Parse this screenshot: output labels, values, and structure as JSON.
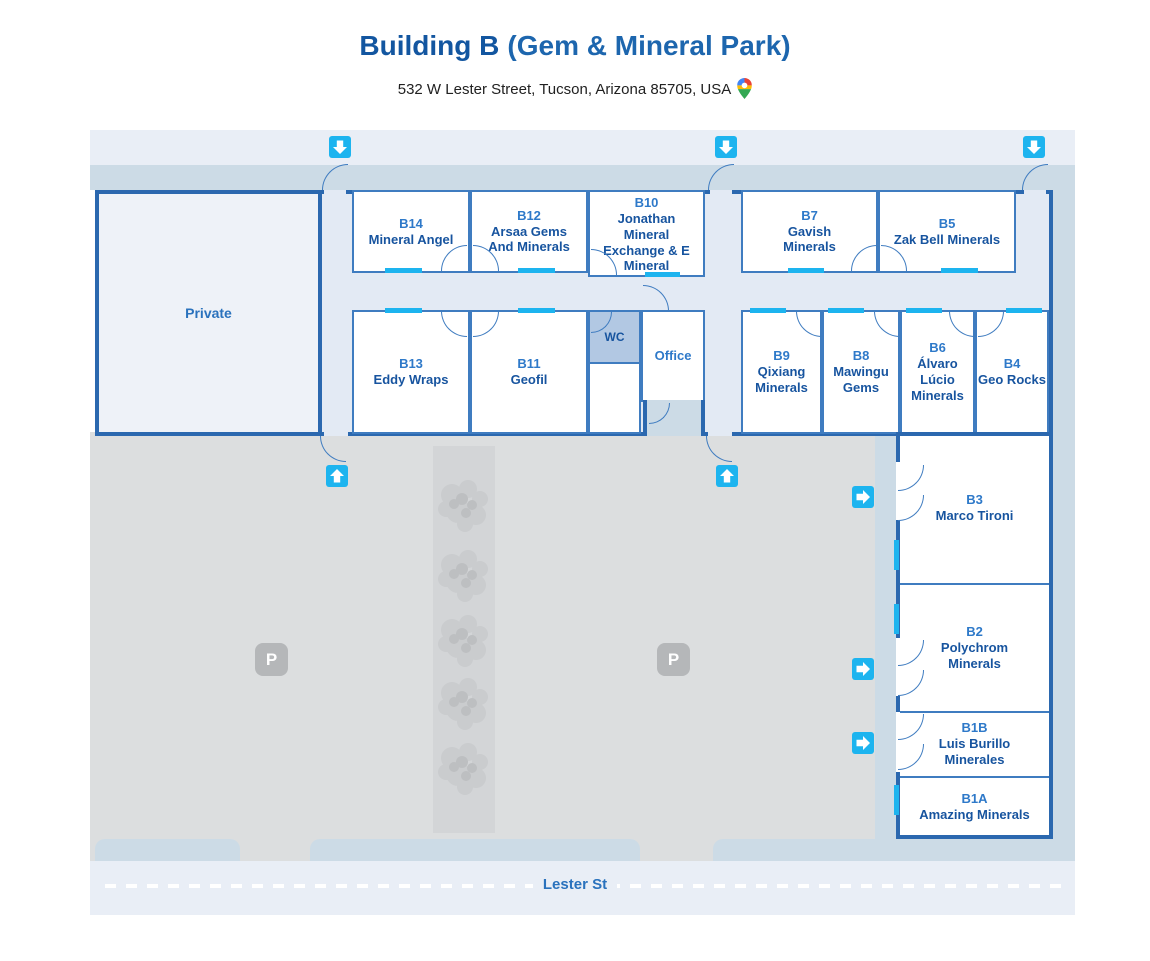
{
  "header": {
    "title_primary": "Building B",
    "title_secondary": "(Gem & Mineral Park)",
    "address": "532 W Lester Street, Tucson, Arizona 85705, USA"
  },
  "map": {
    "street_label": "Lester St",
    "parking_label": "P",
    "labels": {
      "private": "Private",
      "wc": "WC",
      "office": "Office"
    },
    "rooms": {
      "b14": {
        "id": "B14",
        "name": "Mineral Angel"
      },
      "b12": {
        "id": "B12",
        "name": "Arsaa Gems And Minerals"
      },
      "b10": {
        "id": "B10",
        "name": "Jonathan Mineral Exchange & E Mineral"
      },
      "b7": {
        "id": "B7",
        "name": "Gavish Minerals"
      },
      "b5": {
        "id": "B5",
        "name": "Zak Bell Minerals"
      },
      "b13": {
        "id": "B13",
        "name": "Eddy Wraps"
      },
      "b11": {
        "id": "B11",
        "name": "Geofil"
      },
      "b9": {
        "id": "B9",
        "name": "Qixiang Minerals"
      },
      "b8": {
        "id": "B8",
        "name": "Mawingu Gems"
      },
      "b6": {
        "id": "B6",
        "name": "Álvaro Lúcio Minerals"
      },
      "b4": {
        "id": "B4",
        "name": "Geo Rocks"
      },
      "b3": {
        "id": "B3",
        "name": "Marco Tironi"
      },
      "b2": {
        "id": "B2",
        "name": "Polychrom Minerals"
      },
      "b1b": {
        "id": "B1B",
        "name": "Luis Burillo Minerales"
      },
      "b1a": {
        "id": "B1A",
        "name": "Amazing Minerals"
      }
    },
    "colors": {
      "outer_wall": "#2b68af",
      "room_wall": "#3f7cc0",
      "window_and_arrow_cyan": "#1db4ef",
      "room_number_text": "#2e79c9",
      "room_name_text": "#17549f",
      "walkway": "#ccdbe6",
      "corridor": "#e3eaf4",
      "parking": "#dcdedf",
      "road": "#e9eef6",
      "wc_fill": "#b2c8e3",
      "title_blue": "#1356a0"
    },
    "icons": {
      "entrance_arrows": [
        "down",
        "down",
        "down",
        "up",
        "up",
        "right",
        "right",
        "right"
      ],
      "parking_icon": "P-badge",
      "tree_icon": "tree-canopy",
      "address_pin": "google-maps-pin"
    }
  }
}
